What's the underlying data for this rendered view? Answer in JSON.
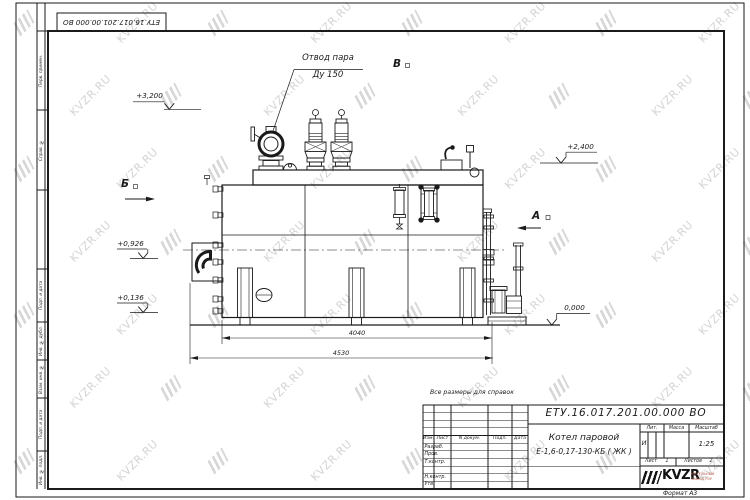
{
  "watermark": {
    "text": "KVZR.RU"
  },
  "frame": {
    "top_stamp": "ЕТУ.16.017.201.00.000  ВО",
    "side_labels": [
      "Перв. примен.",
      "Справ. №",
      "Подп. и дата",
      "Инв. № дубл.",
      "Взам. инв. №",
      "Подп. и дата",
      "Инв. № подл."
    ],
    "format_note": "Формат А3"
  },
  "drawing": {
    "callout_line1": "Отвод пара",
    "callout_line2": "Ду 150",
    "view_b": "Б",
    "view_a": "А",
    "view_v": "В",
    "elevations": [
      "+3,200",
      "+2,400",
      "+0,926",
      "+0,136",
      "0,000"
    ],
    "dim_inner": "4040",
    "dim_outer": "4530"
  },
  "title_block": {
    "note": "Все размеры для справок",
    "doc_number": "ЕТУ.16.017.201.00.000  ВО",
    "product_line1": "Котел паровой",
    "product_line2": "Е-1,6-0,17-130-КБ ( ЖК )",
    "header_row": [
      "Изм.",
      "Лист",
      "N докум.",
      "Подп.",
      "Дата"
    ],
    "row_labels": [
      "Разраб.",
      "Пров.",
      "Т.контр.",
      "Н.контр.",
      "Утв."
    ],
    "lit_header": "Лит.",
    "mass_header": "Масса",
    "scale_header": "Масштаб",
    "lit_value": "И",
    "scale_value": "1:25",
    "sheet_label": "Лист",
    "sheet_value": "1",
    "sheets_label": "Листов",
    "sheets_value": "2",
    "logo_text": "KVZR",
    "logo_sub1": "КОТЕЛЬНЫЙ",
    "logo_sub2": "ЗАВОД РЭУ"
  }
}
